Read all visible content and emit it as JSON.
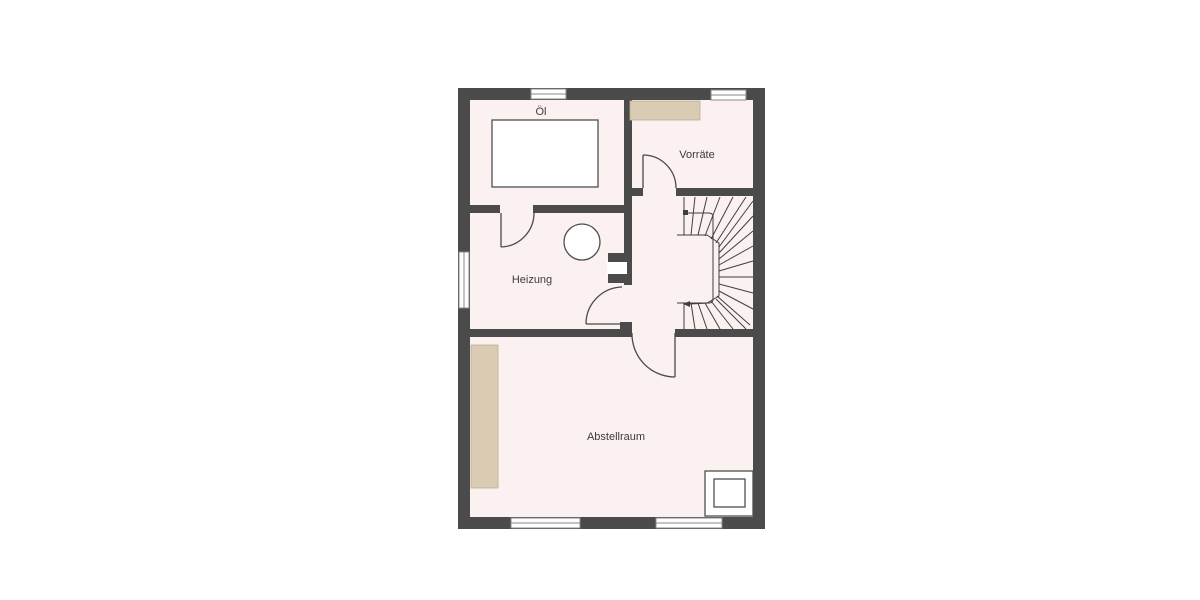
{
  "plan": {
    "type": "floor-plan",
    "rooms": [
      {
        "id": "oel",
        "label": "Öl",
        "features": [
          "oil-tank",
          "window-top"
        ]
      },
      {
        "id": "vorraete",
        "label": "Vorräte",
        "features": [
          "storage-shelf",
          "window-top",
          "door-from-hall"
        ]
      },
      {
        "id": "heizung",
        "label": "Heizung",
        "features": [
          "boiler-circle",
          "chimney",
          "window-left",
          "door-from-hall",
          "door-to-oel"
        ]
      },
      {
        "id": "abstellraum",
        "label": "Abstellraum",
        "features": [
          "storage-shelf",
          "floor-shaft",
          "window-bottom-left",
          "window-bottom-right",
          "door-from-hall"
        ]
      },
      {
        "id": "hall",
        "label": "",
        "features": [
          "winder-stairs",
          "walk-line"
        ]
      }
    ],
    "colors": {
      "background": "#ffffff",
      "wall": "#4b4b4b",
      "floor": "#fbf1f1",
      "shelf": "#d9ccb3",
      "shelf_border": "#bcae93",
      "line": "#3f3f3f",
      "label": "#3c3c3c",
      "window": "#8a8a8a",
      "fixture_fill": "#ffffff"
    }
  }
}
